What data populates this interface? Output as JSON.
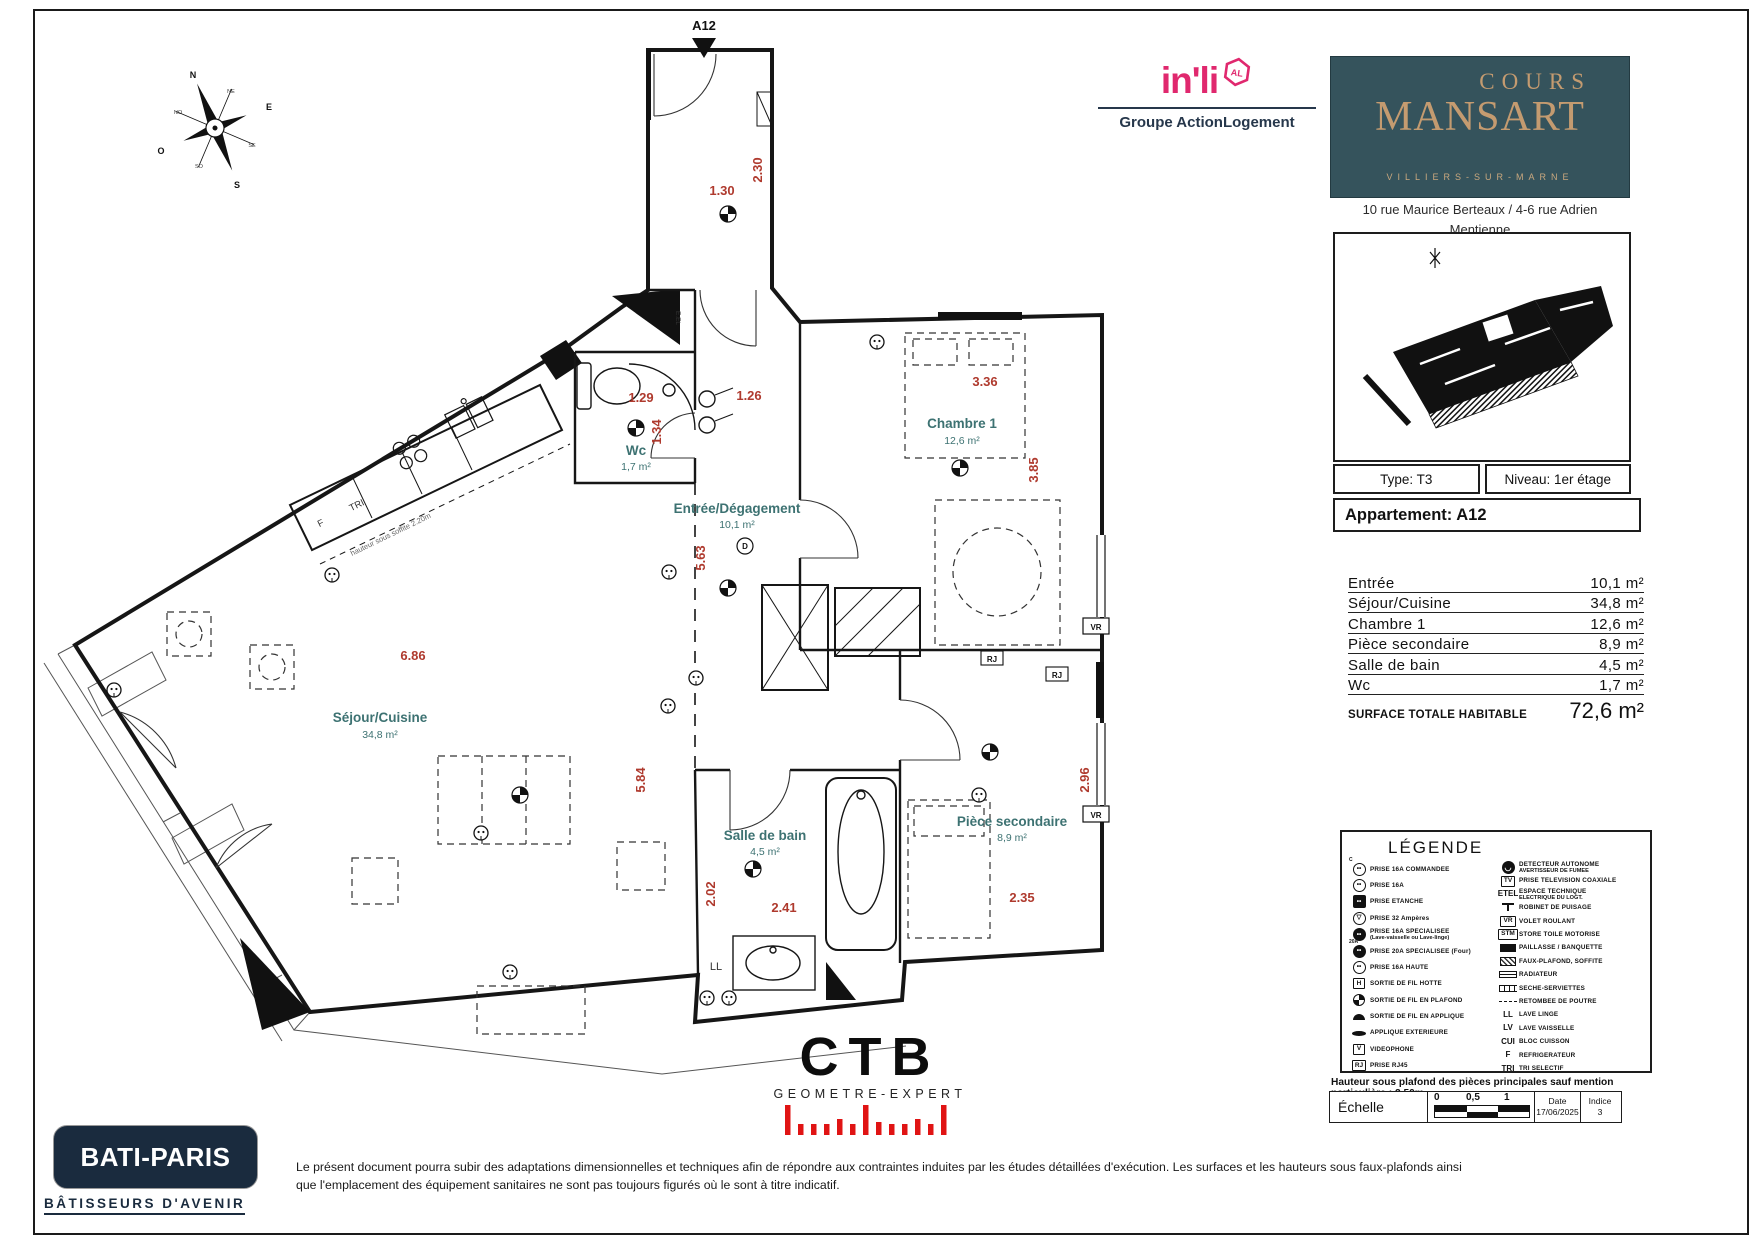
{
  "plan": {
    "unit": "A12",
    "rooms": {
      "wc": {
        "name": "Wc",
        "area": "1,7 m²"
      },
      "chambre1": {
        "name": "Chambre 1",
        "area": "12,6 m²"
      },
      "entree": {
        "name": "Entrée/Dégagement",
        "area": "10,1 m²"
      },
      "sejour": {
        "name": "Séjour/Cuisine",
        "area": "34,8 m²"
      },
      "sdb": {
        "name": "Salle de bain",
        "area": "4,5 m²"
      },
      "piece2": {
        "name": "Pièce secondaire",
        "area": "8,9 m²"
      }
    },
    "dims": {
      "corridor_len": "2.30",
      "corridor_w": "1.30",
      "wc_w": "1.29",
      "wc_h": "1.34",
      "entree_top": "1.26",
      "ch1_w": "3.36",
      "ch1_h": "3.85",
      "entree_len": "5.63",
      "sejour_w": "6.86",
      "sejour_len": "5.84",
      "sdb_len": "2.02",
      "sdb_w": "2.41",
      "ps_len": "2.96",
      "ps_w": "2.35"
    },
    "labels": {
      "eel": "E.EL",
      "door_d": "D",
      "ll": "LL",
      "fridge": "F",
      "tri": "TRI",
      "vr": "VR",
      "rj": "RJ",
      "soffit": "hauteur sous soffite 2.20m"
    },
    "compass": {
      "n": "N",
      "ne": "NE",
      "e": "E",
      "se": "SE",
      "s": "S",
      "so": "SO",
      "o": "O",
      "no": "NO"
    }
  },
  "header": {
    "inli": {
      "logo": "in'li",
      "badge": "AL",
      "group": "Groupe ActionLogement"
    },
    "project": {
      "top": "COURS",
      "main": "MANSART",
      "city": "VILLIERS-SUR-MARNE"
    },
    "address1": "10 rue Maurice Berteaux / 4-6 rue Adrien Mentienne",
    "address2": "94350 Villiers sur Marne"
  },
  "info": {
    "type": "Type: T3",
    "niveau": "Niveau: 1er étage",
    "apartment": "Appartement: A12"
  },
  "surfaces": {
    "rows": [
      {
        "label": "Entrée",
        "value": "10,1 m²"
      },
      {
        "label": "Séjour/Cuisine",
        "value": "34,8 m²"
      },
      {
        "label": "Chambre 1",
        "value": "12,6 m²"
      },
      {
        "label": "Pièce secondaire",
        "value": "8,9 m²"
      },
      {
        "label": "Salle de bain",
        "value": "4,5 m²"
      },
      {
        "label": "Wc",
        "value": "1,7 m²"
      }
    ],
    "total_label": "SURFACE TOTALE HABITABLE",
    "total_value": "72,6 m²"
  },
  "legend": {
    "title": "LÉGENDE",
    "left": [
      {
        "icon": "outlet-commanded-icon",
        "style": "oc",
        "glyph": "••",
        "mark": "C",
        "label": "PRISE 16A COMMANDEE"
      },
      {
        "icon": "outlet-16a-icon",
        "style": "oc",
        "glyph": "••",
        "label": "PRISE 16A"
      },
      {
        "icon": "outlet-sealed-icon",
        "style": "os",
        "glyph": "••",
        "label": "PRISE ETANCHE"
      },
      {
        "icon": "outlet-32a-icon",
        "style": "oc",
        "glyph": "▽",
        "label": "PRISE 32 Ampères"
      },
      {
        "icon": "outlet-dedicated-16a-icon",
        "style": "of",
        "glyph": "••",
        "label": "PRISE 16A SPECIALISEE",
        "sub": "(Lave-vaisselle ou Lave-linge)"
      },
      {
        "icon": "outlet-dedicated-20a-icon",
        "style": "of",
        "glyph": "••",
        "mark": "20A",
        "label": "PRISE 20A SPECIALISEE (Four)"
      },
      {
        "icon": "outlet-high-icon",
        "style": "oc",
        "glyph": "••",
        "label": "PRISE 16A HAUTE"
      },
      {
        "icon": "hood-wire-outlet-icon",
        "style": "bx",
        "glyph": "H",
        "label": "SORTIE DE FIL HOTTE"
      },
      {
        "icon": "ceiling-wire-outlet-icon",
        "style": "dcl",
        "glyph": "",
        "label": "SORTIE DE FIL EN PLAFOND"
      },
      {
        "icon": "wall-wire-outlet-icon",
        "style": "half",
        "glyph": "",
        "label": "SORTIE DE FIL EN APPLIQUE"
      },
      {
        "icon": "exterior-sconce-icon",
        "style": "lamp",
        "glyph": "",
        "label": "APPLIQUE EXTERIEURE"
      },
      {
        "icon": "videophone-icon",
        "style": "bx",
        "glyph": "V",
        "label": "VIDEOPHONE"
      },
      {
        "icon": "rj45-outlet-icon",
        "style": "bx",
        "glyph": "RJ",
        "label": "PRISE RJ45"
      }
    ],
    "right": [
      {
        "icon": "smoke-detector-icon",
        "style": "det",
        "glyph": "◡",
        "label": "DETECTEUR AUTONOME",
        "sub": "AVERTISSEUR DE FUMEE"
      },
      {
        "icon": "tv-outlet-icon",
        "style": "bx",
        "glyph": "TV",
        "label": "PRISE TELEVISION COAXIALE"
      },
      {
        "icon": "etel-icon",
        "style": "txt",
        "glyph": "ETEL",
        "label": "ESPACE TECHNIQUE",
        "sub": "ELECTRIQUE DU LOGT."
      },
      {
        "icon": "water-tap-icon",
        "style": "tap",
        "glyph": "",
        "label": "ROBINET DE PUISAGE"
      },
      {
        "icon": "roller-shutter-icon",
        "style": "bx",
        "glyph": "VR",
        "label": "VOLET ROULANT"
      },
      {
        "icon": "motorized-blind-icon",
        "style": "bx",
        "glyph": "STM",
        "label": "STORE TOILE MOTORISE"
      },
      {
        "icon": "counter-bench-icon",
        "style": "blk",
        "glyph": "",
        "label": "PAILLASSE / BANQUETTE"
      },
      {
        "icon": "dropped-ceiling-icon",
        "style": "hatch",
        "glyph": "",
        "label": "FAUX-PLAFOND, SOFFITE"
      },
      {
        "icon": "radiator-icon",
        "style": "rad",
        "glyph": "",
        "label": "RADIATEUR"
      },
      {
        "icon": "towel-dryer-icon",
        "style": "tow",
        "glyph": "",
        "label": "SECHE-SERVIETTES"
      },
      {
        "icon": "beam-drop-icon",
        "style": "dsh",
        "glyph": "",
        "label": "RETOMBEE DE POUTRE"
      },
      {
        "icon": "washing-machine-icon",
        "style": "txt",
        "glyph": "LL",
        "label": "LAVE LINGE"
      },
      {
        "icon": "dishwasher-icon",
        "style": "txt",
        "glyph": "LV",
        "label": "LAVE VAISSELLE"
      },
      {
        "icon": "cooktop-icon",
        "style": "txt",
        "glyph": "CUI",
        "label": "BLOC CUISSON"
      },
      {
        "icon": "fridge-icon",
        "style": "txt",
        "glyph": "F",
        "label": "REFRIGERATEUR"
      },
      {
        "icon": "sorting-icon",
        "style": "txt",
        "glyph": "TRI",
        "label": "TRI SELECTIF"
      }
    ]
  },
  "notes": {
    "ceiling": "Hauteur sous plafond des pièces principales sauf mention particulière : 2.50m"
  },
  "scalebar": {
    "label": "Échelle",
    "t0": "0",
    "t1": "0,5",
    "t2": "1",
    "date_label": "Date",
    "date": "17/06/2025",
    "indice_label": "Indice",
    "indice": "3"
  },
  "footer": {
    "batiparis": {
      "name": "BATI-PARIS",
      "tagline": "BÂTISSEURS D'AVENIR"
    },
    "ctb": {
      "name": "CTB",
      "subtitle": "GEOMETRE-EXPERT"
    },
    "disclaimer": "Le présent document pourra subir des adaptations dimensionnelles et techniques afin de répondre aux contraintes induites par les études détaillées d'exécution. Les surfaces et les hauteurs sous faux-plafonds ainsi que l'emplacement des équipement sanitaires ne sont pas toujours figurés où le sont à titre indicatif."
  }
}
